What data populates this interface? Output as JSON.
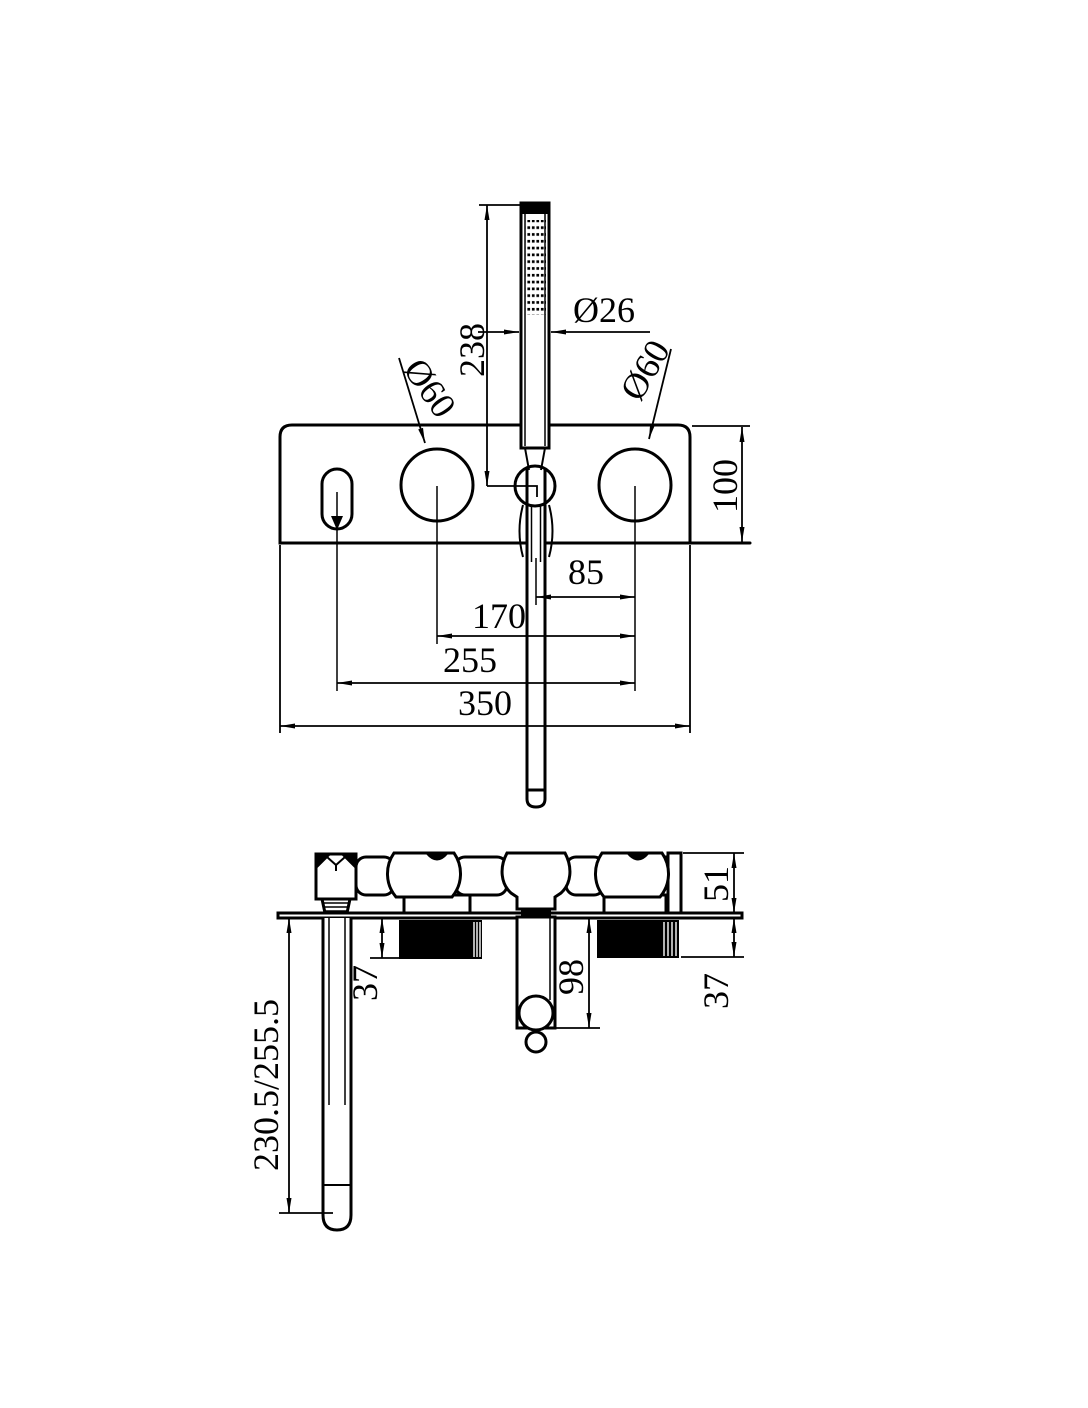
{
  "drawing": {
    "title": "bath-mixer-with-handshower-technical-drawing",
    "colors": {
      "line": "#000000",
      "background": "#ffffff"
    },
    "front_view": {
      "labels": {
        "handshower_length": "238",
        "handshower_diameter": "Ø26",
        "left_knob_diameter": "Ø60",
        "right_knob_diameter": "Ø60",
        "plate_height": "100",
        "center_to_right_knob": "85",
        "knob_to_knob": "170",
        "diverter_to_right_knob": "255",
        "plate_width": "350"
      }
    },
    "side_view": {
      "labels": {
        "body_depth": "51",
        "left_valve_depth": "37",
        "outlet_drop": "98",
        "right_valve_depth": "37",
        "spout_length": "230.5/255.5"
      }
    }
  }
}
